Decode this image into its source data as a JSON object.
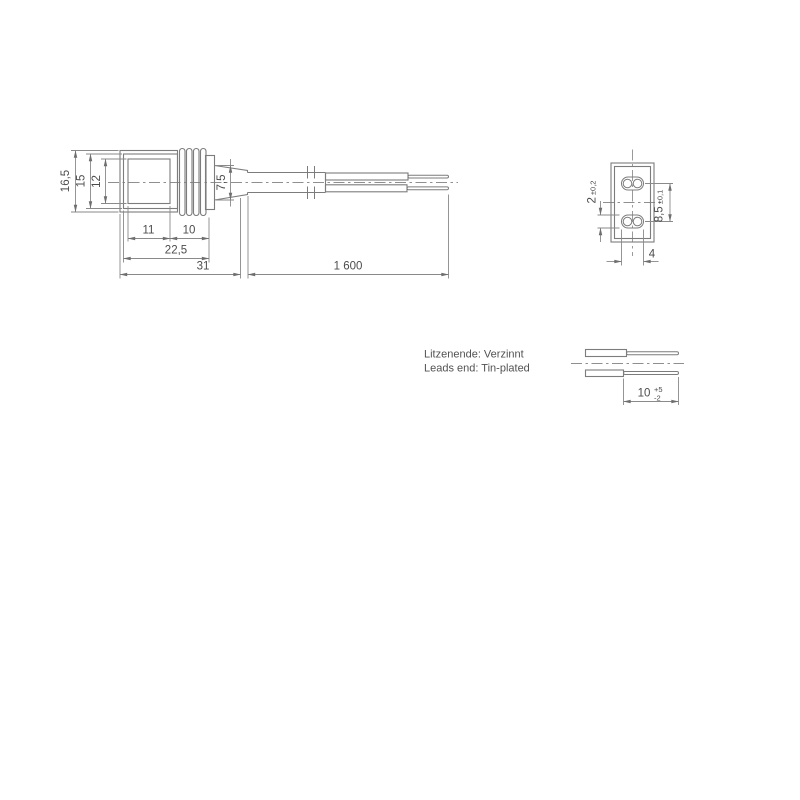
{
  "drawing": {
    "notes": {
      "line1": "Litzenende: Verzinnt",
      "line2": "Leads end: Tin-plated"
    },
    "side_view": {
      "dim_height_outer": "16,5",
      "dim_height_mid": "15",
      "dim_height_inner": "12",
      "dim_inner_width": "11",
      "dim_rib_width": "10",
      "dim_front_length": "22,5",
      "dim_body_length": "31",
      "dim_cable_length": "1 600",
      "dim_boot_height": "7,5"
    },
    "front_view": {
      "dim_slot_height": "2",
      "dim_slot_height_tol": "±0,2",
      "dim_pitch": "8,5",
      "dim_pitch_tol": "±0,1",
      "dim_slot_width": "4"
    },
    "detail_view": {
      "dim_strip_length": "10",
      "dim_strip_tol_plus": "+5",
      "dim_strip_tol_minus": "-2"
    }
  }
}
